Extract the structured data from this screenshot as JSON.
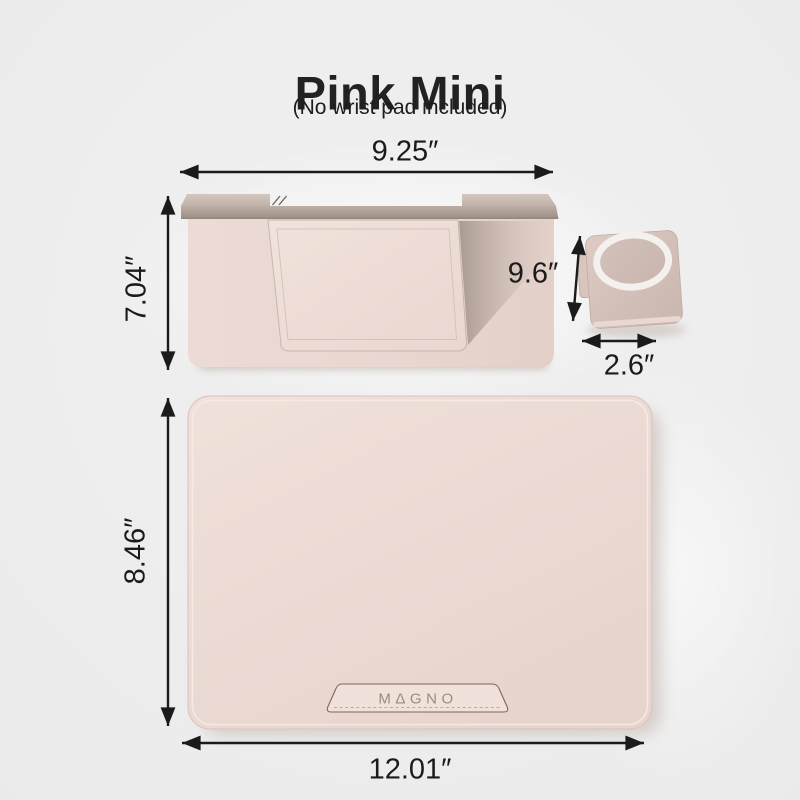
{
  "header": {
    "title": "Pink Mini",
    "subtitle": "(No wrist pad included)"
  },
  "dimensions": {
    "stand_width": "9.25″",
    "stand_height": "7.04″",
    "stand_depth": "9.6″",
    "phone_mount_width": "2.6″",
    "mat_height": "8.46″",
    "mat_width": "12.01″"
  },
  "brand": {
    "name": "MAGNO",
    "letters": [
      "M",
      "Δ",
      "G",
      "N",
      "O"
    ]
  },
  "colors": {
    "background": "#ececec",
    "product_pink": "#ecdbd4",
    "metallic_champagne": "#b5a79e",
    "magsafe_ring_white": "#f4f0ed",
    "dimension_arrow": "#1b1b1b",
    "title_text": "#222222",
    "brand_text": "#a08a7e"
  }
}
